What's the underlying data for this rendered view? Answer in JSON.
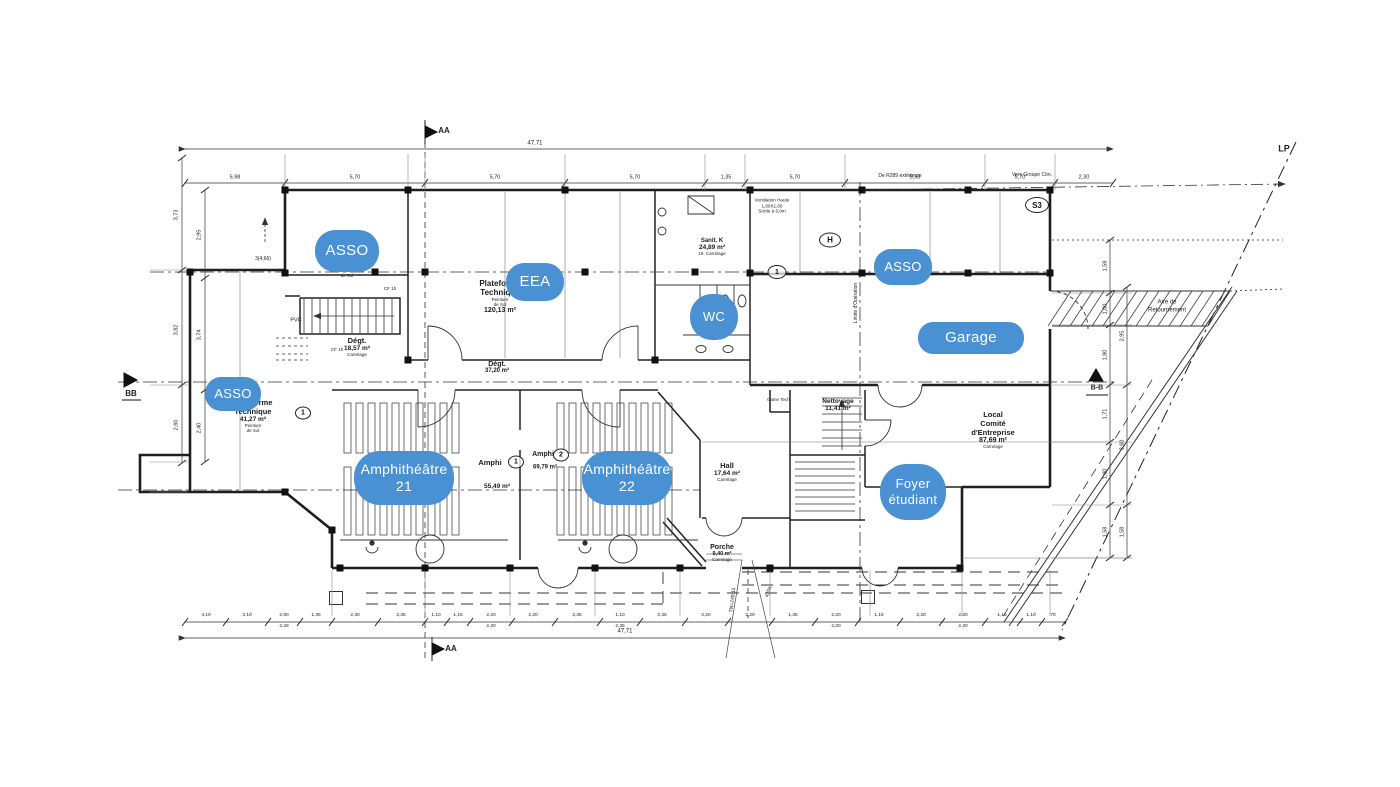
{
  "colors": {
    "overlay_blue": "#4a91d3",
    "overlay_text": "#ffffff",
    "ink": "#222222"
  },
  "overlays": [
    {
      "name": "overlay-asso-1",
      "lines": [
        "ASSO"
      ],
      "cx": 347,
      "cy": 251,
      "w": 64,
      "h": 42,
      "fs": 15
    },
    {
      "name": "overlay-eea",
      "lines": [
        "EEA"
      ],
      "cx": 535,
      "cy": 282,
      "w": 58,
      "h": 38,
      "fs": 15
    },
    {
      "name": "overlay-wc",
      "lines": [
        "WC"
      ],
      "cx": 714,
      "cy": 317,
      "w": 48,
      "h": 46,
      "fs": 13
    },
    {
      "name": "overlay-asso-2",
      "lines": [
        "ASSO"
      ],
      "cx": 903,
      "cy": 267,
      "w": 58,
      "h": 36,
      "fs": 13
    },
    {
      "name": "overlay-garage",
      "lines": [
        "Garage"
      ],
      "cx": 971,
      "cy": 338,
      "w": 106,
      "h": 32,
      "fs": 15
    },
    {
      "name": "overlay-asso-3",
      "lines": [
        "ASSO"
      ],
      "cx": 233,
      "cy": 394,
      "w": 56,
      "h": 34,
      "fs": 13
    },
    {
      "name": "overlay-amphitheatre-21",
      "lines": [
        "Amphithéâtre",
        "21"
      ],
      "cx": 404,
      "cy": 478,
      "w": 100,
      "h": 54,
      "fs": 14
    },
    {
      "name": "overlay-amphitheatre-22",
      "lines": [
        "Amphithéâtre",
        "22"
      ],
      "cx": 627,
      "cy": 478,
      "w": 90,
      "h": 54,
      "fs": 14
    },
    {
      "name": "overlay-foyer-etudiant",
      "lines": [
        "Foyer",
        "étudiant"
      ],
      "cx": 913,
      "cy": 492,
      "w": 66,
      "h": 56,
      "fs": 13
    }
  ],
  "rooms": [
    {
      "name": "plateforme-technique-120",
      "x": 500,
      "top": 279,
      "lines": [
        [
          "Plateforme",
          8,
          1
        ],
        [
          "Technique",
          8,
          1
        ],
        [
          "Peinture",
          4.5,
          0
        ],
        [
          "de Sol",
          4.5,
          0
        ],
        [
          "120,13 m²",
          7,
          1
        ]
      ]
    },
    {
      "name": "degt-1857",
      "x": 357,
      "top": 336,
      "lines": [
        [
          "Dégt.",
          7.5,
          1
        ],
        [
          "18,57 m²",
          6.5,
          1
        ],
        [
          "Carrelage",
          4.5,
          0
        ]
      ]
    },
    {
      "name": "degt-3720",
      "x": 497,
      "top": 361,
      "lines": [
        [
          "Dégt.",
          7,
          1
        ],
        [
          "37,20 m²",
          6,
          1
        ]
      ]
    },
    {
      "name": "sanit-k",
      "x": 712,
      "top": 238,
      "lines": [
        [
          "Sanit. K",
          6,
          1
        ],
        [
          "24,89 m²",
          6.5,
          1
        ],
        [
          "19. Carrelage",
          4.5,
          0
        ]
      ]
    },
    {
      "name": "amphi-1",
      "x": 490,
      "top": 458,
      "lines": [
        [
          "Amphi",
          7.5,
          1
        ]
      ]
    },
    {
      "name": "amphi-2",
      "x": 543,
      "top": 451,
      "lines": [
        [
          "Amphi",
          7,
          1
        ]
      ]
    },
    {
      "name": "hall",
      "x": 727,
      "top": 461,
      "lines": [
        [
          "Hall",
          7.5,
          1
        ],
        [
          "17,64 m²",
          6.5,
          1
        ],
        [
          "Carrelage",
          4.5,
          0
        ]
      ]
    },
    {
      "name": "nettoyage",
      "x": 838,
      "top": 398,
      "lines": [
        [
          "Nettoyage",
          6.5,
          1
        ],
        [
          "11,41 m²",
          6.5,
          1
        ]
      ]
    },
    {
      "name": "local-comite-entreprise",
      "x": 993,
      "top": 410,
      "lines": [
        [
          "Local",
          7.5,
          1
        ],
        [
          "Comité",
          7.5,
          1
        ],
        [
          "d'Entreprise",
          7.5,
          1
        ],
        [
          "87,69 m²",
          7,
          1
        ],
        [
          "Carrelage",
          4.5,
          0
        ]
      ]
    },
    {
      "name": "porche",
      "x": 722,
      "top": 544,
      "lines": [
        [
          "Porche",
          7,
          1
        ],
        [
          "9,40 m²",
          5.5,
          1
        ],
        [
          "Carrelage",
          4.5,
          0
        ]
      ]
    },
    {
      "name": "plateforme-technique-41",
      "x": 253,
      "top": 398,
      "lines": [
        [
          "Plateforme",
          7.5,
          1
        ],
        [
          "Technique",
          7.5,
          1
        ],
        [
          "41,27 m²",
          6.5,
          1
        ],
        [
          "Peinture",
          4.5,
          0
        ],
        [
          "de Sol",
          4.5,
          0
        ]
      ]
    }
  ],
  "badges": [
    {
      "t": "1",
      "cx": 777,
      "cy": 272,
      "w": 17,
      "h": 12,
      "fs": 7
    },
    {
      "t": "H",
      "cx": 830,
      "cy": 240,
      "w": 20,
      "h": 13,
      "fs": 8
    },
    {
      "t": "S3",
      "cx": 1037,
      "cy": 205,
      "w": 22,
      "h": 14,
      "fs": 8
    },
    {
      "t": "1",
      "cx": 516,
      "cy": 462,
      "w": 14,
      "h": 11,
      "fs": 7
    },
    {
      "t": "2",
      "cx": 561,
      "cy": 455,
      "w": 14,
      "h": 11,
      "fs": 7
    },
    {
      "t": "1",
      "cx": 303,
      "cy": 413,
      "w": 14,
      "h": 11,
      "fs": 7
    }
  ],
  "annotations": [
    {
      "t": "AA",
      "x": 444,
      "y": 131,
      "fs": 8,
      "b": 1
    },
    {
      "t": "AA",
      "x": 451,
      "y": 649,
      "fs": 8,
      "b": 1
    },
    {
      "t": "BB",
      "x": 131,
      "y": 394,
      "fs": 8,
      "b": 1
    },
    {
      "t": "B-B",
      "x": 1097,
      "y": 389,
      "fs": 7,
      "b": 1
    },
    {
      "t": "LP",
      "x": 1284,
      "y": 149,
      "fs": 9,
      "b": 1
    },
    {
      "t": "47,71",
      "x": 535,
      "y": 144,
      "fs": 6
    },
    {
      "t": "47,71",
      "x": 625,
      "y": 632,
      "fs": 6
    },
    {
      "t": "Ventilation Haute\n1,60X1,60\nSortie à 6,0m",
      "x": 772,
      "y": 206,
      "fs": 4.6
    },
    {
      "t": "De R289 extérieure",
      "x": 900,
      "y": 176,
      "fs": 5
    },
    {
      "t": "Vers Groupe Cön.",
      "x": 1032,
      "y": 175,
      "fs": 5
    },
    {
      "t": "Aire de\nRetournement",
      "x": 1167,
      "y": 307,
      "fs": 6
    },
    {
      "t": "PVC",
      "x": 296,
      "y": 321,
      "fs": 5.5
    },
    {
      "t": "CF 1h",
      "x": 390,
      "y": 289,
      "fs": 4.6
    },
    {
      "t": "CF 1h",
      "x": 337,
      "y": 350,
      "fs": 4.6
    },
    {
      "t": "3(4,66)",
      "x": 263,
      "y": 259,
      "fs": 5
    },
    {
      "t": "de Sol",
      "x": 347,
      "y": 276,
      "fs": 4.5
    },
    {
      "t": "Gaine Tech.",
      "x": 779,
      "y": 400,
      "fs": 4.5
    },
    {
      "t": "55,49 m²",
      "x": 497,
      "y": 487,
      "fs": 6.5,
      "b": 1
    },
    {
      "t": "69,79 m²",
      "x": 545,
      "y": 468,
      "fs": 6,
      "b": 1
    },
    {
      "t": "TN=249.15",
      "x": 733,
      "y": 600,
      "fs": 5,
      "rot": -83
    },
    {
      "t": "4,0%",
      "x": 769,
      "y": 592,
      "fs": 5,
      "rot": -70
    },
    {
      "t": "Limite d'Opération",
      "x": 856,
      "y": 303,
      "fs": 5,
      "rot": -90
    },
    {
      "t": "5,98",
      "x": 235,
      "y": 178,
      "fs": 5.5
    },
    {
      "t": "5,70",
      "x": 355,
      "y": 178,
      "fs": 5.5
    },
    {
      "t": "5,70",
      "x": 495,
      "y": 178,
      "fs": 5.5
    },
    {
      "t": "5,70",
      "x": 635,
      "y": 178,
      "fs": 5.5
    },
    {
      "t": "1,35",
      "x": 726,
      "y": 178,
      "fs": 5.5
    },
    {
      "t": "5,70",
      "x": 795,
      "y": 178,
      "fs": 5.5
    },
    {
      "t": "5,98",
      "x": 915,
      "y": 178,
      "fs": 5.5
    },
    {
      "t": "5,70",
      "x": 1020,
      "y": 178,
      "fs": 5.5
    },
    {
      "t": "2,30",
      "x": 1084,
      "y": 178,
      "fs": 5.5
    },
    {
      "t": "4,10",
      "x": 206,
      "y": 616,
      "fs": 4.8
    },
    {
      "t": "3,10",
      "x": 247,
      "y": 616,
      "fs": 4.8
    },
    {
      "t": "2,90",
      "x": 284,
      "y": 616,
      "fs": 4.8
    },
    {
      "t": "1,35",
      "x": 316,
      "y": 616,
      "fs": 4.8
    },
    {
      "t": "2,30",
      "x": 355,
      "y": 616,
      "fs": 4.8
    },
    {
      "t": "2,35",
      "x": 401,
      "y": 616,
      "fs": 4.8
    },
    {
      "t": "1,10",
      "x": 436,
      "y": 616,
      "fs": 4.8
    },
    {
      "t": "1,15",
      "x": 458,
      "y": 616,
      "fs": 4.8
    },
    {
      "t": "2,20",
      "x": 491,
      "y": 616,
      "fs": 4.8
    },
    {
      "t": "2,20",
      "x": 533,
      "y": 616,
      "fs": 4.8
    },
    {
      "t": "2,35",
      "x": 577,
      "y": 616,
      "fs": 4.8
    },
    {
      "t": "1,10",
      "x": 620,
      "y": 616,
      "fs": 4.8
    },
    {
      "t": "2,35",
      "x": 662,
      "y": 616,
      "fs": 4.8
    },
    {
      "t": "2,20",
      "x": 706,
      "y": 616,
      "fs": 4.8
    },
    {
      "t": "2,20",
      "x": 750,
      "y": 616,
      "fs": 4.8
    },
    {
      "t": "1,35",
      "x": 793,
      "y": 616,
      "fs": 4.8
    },
    {
      "t": "2,20",
      "x": 836,
      "y": 616,
      "fs": 4.8
    },
    {
      "t": "1,15",
      "x": 879,
      "y": 616,
      "fs": 4.8
    },
    {
      "t": "2,20",
      "x": 921,
      "y": 616,
      "fs": 4.8
    },
    {
      "t": "2,20",
      "x": 963,
      "y": 616,
      "fs": 4.8
    },
    {
      "t": "1,15",
      "x": 1002,
      "y": 616,
      "fs": 4.8
    },
    {
      "t": "1,10",
      "x": 1031,
      "y": 616,
      "fs": 4.8
    },
    {
      "t": "70",
      "x": 1053,
      "y": 616,
      "fs": 4.8
    },
    {
      "t": "2,28",
      "x": 284,
      "y": 627,
      "fs": 4.8
    },
    {
      "t": "2,20",
      "x": 491,
      "y": 627,
      "fs": 4.8
    },
    {
      "t": "2,35",
      "x": 620,
      "y": 627,
      "fs": 4.8
    },
    {
      "t": "2,20",
      "x": 836,
      "y": 627,
      "fs": 4.8
    },
    {
      "t": "2,20",
      "x": 963,
      "y": 627,
      "fs": 4.8
    },
    {
      "t": "3,73",
      "x": 177,
      "y": 215,
      "fs": 5.5,
      "rot": -90
    },
    {
      "t": "3,82",
      "x": 177,
      "y": 330,
      "fs": 5.5,
      "rot": -90
    },
    {
      "t": "2,60",
      "x": 177,
      "y": 425,
      "fs": 5.5,
      "rot": -90
    },
    {
      "t": "2,95",
      "x": 200,
      "y": 235,
      "fs": 5.5,
      "rot": -90
    },
    {
      "t": "3,74",
      "x": 200,
      "y": 335,
      "fs": 5.5,
      "rot": -90
    },
    {
      "t": "2,40",
      "x": 200,
      "y": 428,
      "fs": 5.5,
      "rot": -90
    },
    {
      "t": "1,58",
      "x": 1106,
      "y": 266,
      "fs": 5.5,
      "rot": -90
    },
    {
      "t": "1,00",
      "x": 1106,
      "y": 309,
      "fs": 5.5,
      "rot": -90
    },
    {
      "t": "1,80",
      "x": 1106,
      "y": 355,
      "fs": 5.5,
      "rot": -90
    },
    {
      "t": "1,71",
      "x": 1106,
      "y": 414,
      "fs": 5.5,
      "rot": -90
    },
    {
      "t": "1,90",
      "x": 1106,
      "y": 474,
      "fs": 5.5,
      "rot": -90
    },
    {
      "t": "1,58",
      "x": 1106,
      "y": 532,
      "fs": 5.5,
      "rot": -90
    },
    {
      "t": "2,95",
      "x": 1123,
      "y": 336,
      "fs": 5.5,
      "rot": -90
    },
    {
      "t": "3,60",
      "x": 1123,
      "y": 445,
      "fs": 5.5,
      "rot": -90
    },
    {
      "t": "1,58",
      "x": 1123,
      "y": 532,
      "fs": 5.5,
      "rot": -90
    }
  ],
  "dimlines": [
    {
      "o": "h",
      "y": 149,
      "x1": 185,
      "x2": 1113,
      "arrows": true
    },
    {
      "o": "h",
      "y": 183,
      "x1": 185,
      "x2": 1113,
      "ticks": [
        185,
        285,
        425,
        565,
        705,
        745,
        845,
        985,
        1055,
        1113
      ]
    },
    {
      "o": "h",
      "y": 622,
      "x1": 185,
      "x2": 1065,
      "ticks": [
        185,
        226,
        268,
        300,
        332,
        378,
        425,
        447,
        470,
        512,
        555,
        600,
        640,
        685,
        728,
        772,
        815,
        858,
        900,
        942,
        985,
        1020,
        1042,
        1065
      ]
    },
    {
      "o": "h",
      "y": 638,
      "x1": 185,
      "x2": 1065,
      "arrows": true
    },
    {
      "o": "v",
      "x": 182,
      "y1": 158,
      "y2": 463,
      "ticks": [
        158,
        270,
        385,
        463
      ]
    },
    {
      "o": "v",
      "x": 205,
      "y1": 190,
      "y2": 462,
      "ticks": [
        190,
        278,
        390,
        462
      ]
    },
    {
      "o": "v",
      "x": 1110,
      "y1": 240,
      "y2": 558,
      "ticks": [
        240,
        293,
        325,
        385,
        442,
        505,
        558
      ]
    },
    {
      "o": "v",
      "x": 1127,
      "y1": 287,
      "y2": 558,
      "ticks": [
        287,
        385,
        505,
        558
      ]
    }
  ]
}
